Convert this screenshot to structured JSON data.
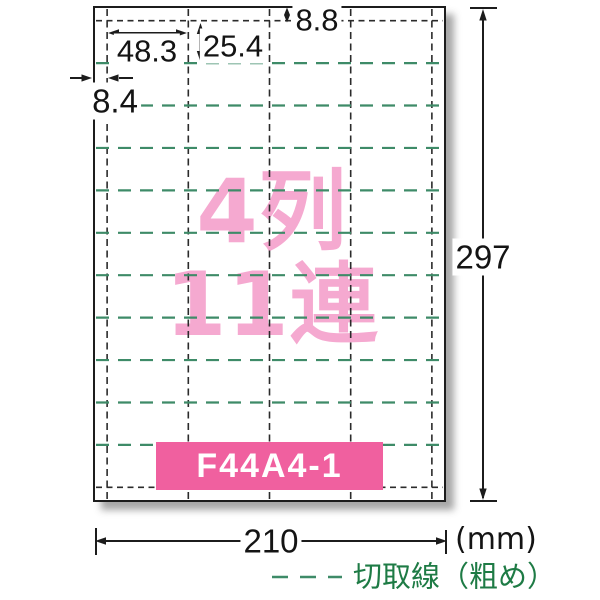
{
  "sheet": {
    "columns": 4,
    "rows": 11,
    "headline_line1": "4列",
    "headline_line2": "11連",
    "product_code": "F44A4-1"
  },
  "dimensions": {
    "label_width_mm": "48.3",
    "label_height_mm": "25.4",
    "top_margin_mm": "8.8",
    "left_margin_mm": "8.4",
    "sheet_height_mm": "297",
    "sheet_width_mm": "210",
    "unit_label": "(mm)"
  },
  "legend": {
    "cut_line_label": "切取線（粗め）"
  },
  "colors": {
    "headline_pink": "#F5A9D0",
    "code_box_pink": "#F0609F",
    "cut_line_green": "#3E8B68",
    "legend_green": "#1E7B45",
    "line_black": "#1c1c1c"
  }
}
